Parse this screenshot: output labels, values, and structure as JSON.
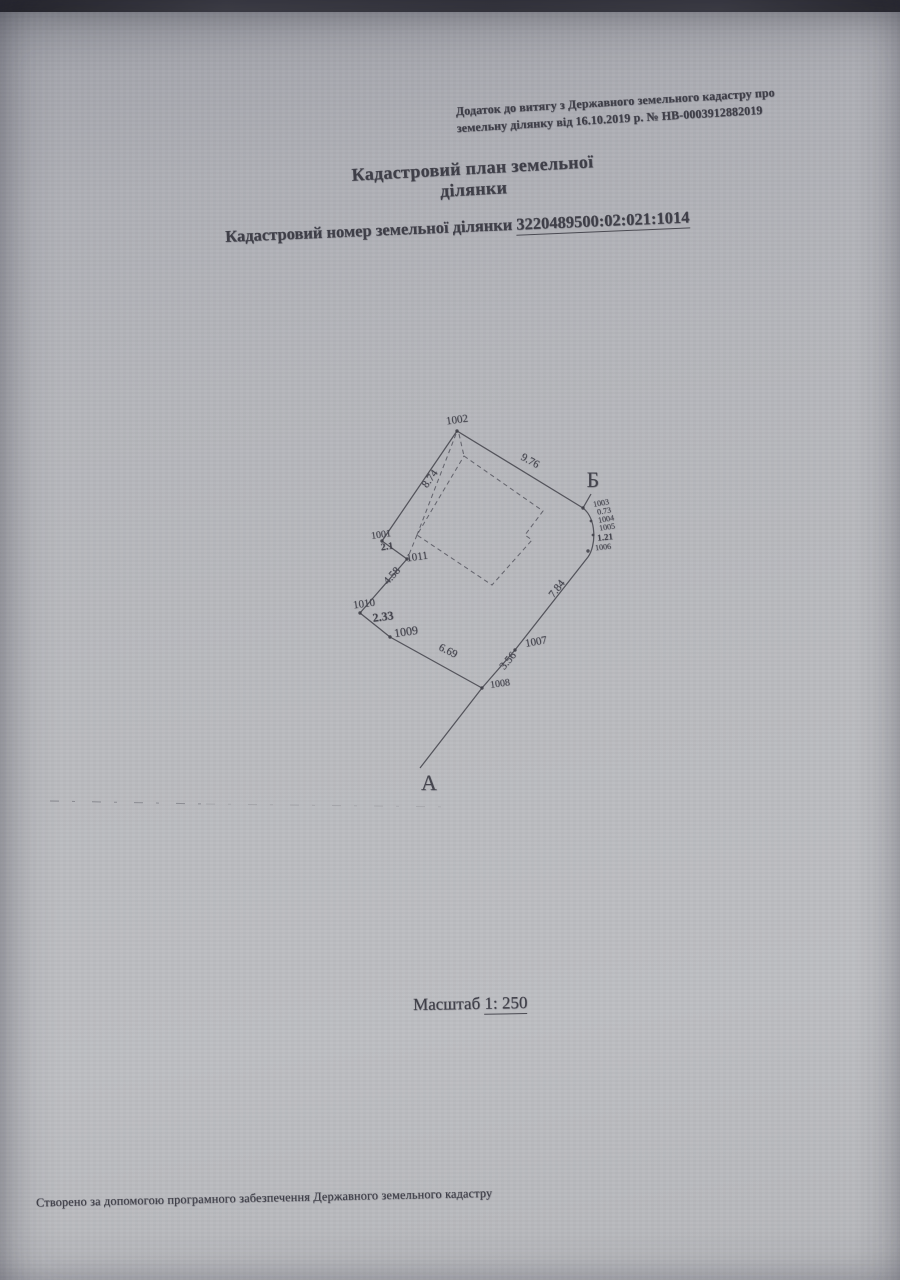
{
  "page": {
    "annex_note": {
      "line1": "Додаток до витягу з Державного земельного кадастру про",
      "line2": "земельну ділянку від 16.10.2019 р. № НВ-0003912882019"
    },
    "title": "Кадастровий план земельної ділянки",
    "cadastral": {
      "label": "Кадастровий номер земельної ділянки",
      "number": "3220489500:02:021:1014"
    },
    "scale": {
      "label": "Масштаб",
      "value": "1: 250"
    },
    "footer": "Створено за допомогою програмного забезпечення Державного земельного кадастру"
  },
  "plan": {
    "labels": [
      {
        "text": "1002",
        "x": 457,
        "y": 420,
        "rot": -8,
        "size": 11
      },
      {
        "text": "9.76",
        "x": 530,
        "y": 461,
        "rot": 29,
        "size": 11
      },
      {
        "text": "8.74",
        "x": 430,
        "y": 479,
        "rot": -54,
        "size": 11
      },
      {
        "text": "1003",
        "x": 601,
        "y": 503,
        "rot": -10,
        "size": 8
      },
      {
        "text": "0.73",
        "x": 604,
        "y": 511,
        "rot": -10,
        "size": 8
      },
      {
        "text": "1004",
        "x": 606,
        "y": 519,
        "rot": -10,
        "size": 8
      },
      {
        "text": "1005",
        "x": 607,
        "y": 527,
        "rot": -8,
        "size": 8
      },
      {
        "text": "1.21",
        "x": 605,
        "y": 537,
        "rot": -6,
        "size": 9,
        "bold": true
      },
      {
        "text": "1006",
        "x": 603,
        "y": 547,
        "rot": -6,
        "size": 8
      },
      {
        "text": "7.84",
        "x": 557,
        "y": 589,
        "rot": -52,
        "size": 11
      },
      {
        "text": "1007",
        "x": 536,
        "y": 642,
        "rot": -10,
        "size": 11
      },
      {
        "text": "3.56",
        "x": 508,
        "y": 661,
        "rot": -50,
        "size": 11
      },
      {
        "text": "1008",
        "x": 500,
        "y": 684,
        "rot": -8,
        "size": 10
      },
      {
        "text": "6.69",
        "x": 448,
        "y": 651,
        "rot": 26,
        "size": 11
      },
      {
        "text": "1009",
        "x": 406,
        "y": 632,
        "rot": -8,
        "size": 12
      },
      {
        "text": "2.33",
        "x": 383,
        "y": 617,
        "rot": -8,
        "size": 12,
        "bold": true
      },
      {
        "text": "1010",
        "x": 364,
        "y": 604,
        "rot": -8,
        "size": 11
      },
      {
        "text": "4.58",
        "x": 392,
        "y": 576,
        "rot": -48,
        "size": 11
      },
      {
        "text": "1011",
        "x": 417,
        "y": 557,
        "rot": -8,
        "size": 11
      },
      {
        "text": "2.1",
        "x": 387,
        "y": 547,
        "rot": -8,
        "size": 10,
        "bold": true
      },
      {
        "text": "1001",
        "x": 381,
        "y": 535,
        "rot": -8,
        "size": 10
      },
      {
        "text": "А",
        "x": 429,
        "y": 783,
        "rot": 0,
        "size": 22
      },
      {
        "text": "Б",
        "x": 593,
        "y": 480,
        "rot": 0,
        "size": 22
      }
    ]
  },
  "colors": {
    "paper": "#b7b8bc",
    "ink": "#3f3f48",
    "line": "#45454d"
  }
}
